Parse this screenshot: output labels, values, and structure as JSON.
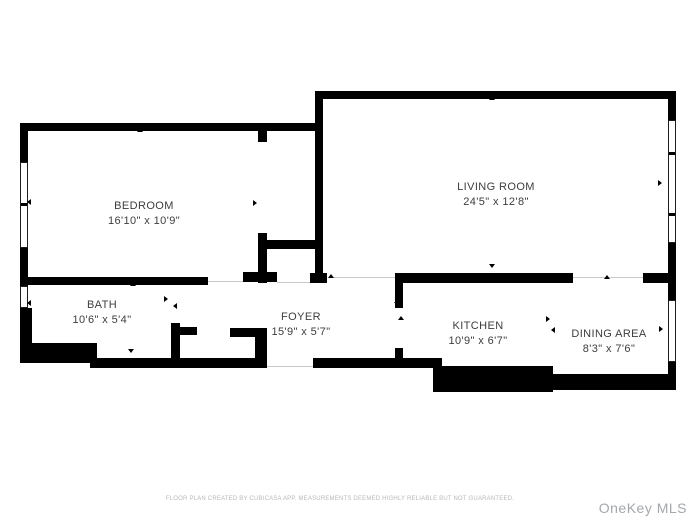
{
  "canvas": {
    "width": 693,
    "height": 520,
    "background": "#ffffff",
    "wall_color": "#000000",
    "label_color": "#3d3d3d"
  },
  "rooms": [
    {
      "id": "bedroom",
      "name": "BEDROOM",
      "dims": "16'10\" x 10'9\"",
      "cx": 144,
      "cy": 207
    },
    {
      "id": "living-room",
      "name": "LIVING ROOM",
      "dims": "24'5\" x 12'8\"",
      "cx": 496,
      "cy": 188
    },
    {
      "id": "bath",
      "name": "BATH",
      "dims": "10'6\" x 5'4\"",
      "cx": 102,
      "cy": 306
    },
    {
      "id": "foyer",
      "name": "FOYER",
      "dims": "15'9\" x 5'7\"",
      "cx": 301,
      "cy": 318
    },
    {
      "id": "kitchen",
      "name": "KITCHEN",
      "dims": "10'9\" x 6'7\"",
      "cx": 478,
      "cy": 327
    },
    {
      "id": "dining-area",
      "name": "DINING AREA",
      "dims": "8'3\" x 7'6\"",
      "cx": 609,
      "cy": 335
    }
  ],
  "walls": [
    {
      "x": 20,
      "y": 123,
      "w": 303,
      "h": 8
    },
    {
      "x": 20,
      "y": 123,
      "w": 8,
      "h": 39
    },
    {
      "x": 20,
      "y": 248,
      "w": 8,
      "h": 38
    },
    {
      "x": 20,
      "y": 277,
      "w": 188,
      "h": 8
    },
    {
      "x": 258,
      "y": 131,
      "w": 9,
      "h": 11
    },
    {
      "x": 258,
      "y": 233,
      "w": 9,
      "h": 50
    },
    {
      "x": 258,
      "y": 240,
      "w": 65,
      "h": 9
    },
    {
      "x": 243,
      "y": 272,
      "w": 34,
      "h": 10
    },
    {
      "x": 310,
      "y": 273,
      "w": 17,
      "h": 10
    },
    {
      "x": 315,
      "y": 91,
      "w": 361,
      "h": 8
    },
    {
      "x": 315,
      "y": 91,
      "w": 8,
      "h": 189
    },
    {
      "x": 668,
      "y": 91,
      "w": 8,
      "h": 29
    },
    {
      "x": 668,
      "y": 243,
      "w": 8,
      "h": 57
    },
    {
      "x": 643,
      "y": 273,
      "w": 33,
      "h": 10
    },
    {
      "x": 395,
      "y": 273,
      "w": 178,
      "h": 10
    },
    {
      "x": 20,
      "y": 308,
      "w": 12,
      "h": 37
    },
    {
      "x": 20,
      "y": 343,
      "w": 77,
      "h": 20
    },
    {
      "x": 90,
      "y": 358,
      "w": 177,
      "h": 10
    },
    {
      "x": 171,
      "y": 323,
      "w": 9,
      "h": 40
    },
    {
      "x": 171,
      "y": 327,
      "w": 26,
      "h": 8
    },
    {
      "x": 230,
      "y": 328,
      "w": 37,
      "h": 9
    },
    {
      "x": 255,
      "y": 328,
      "w": 12,
      "h": 35
    },
    {
      "x": 313,
      "y": 358,
      "w": 129,
      "h": 10
    },
    {
      "x": 395,
      "y": 275,
      "w": 8,
      "h": 33
    },
    {
      "x": 395,
      "y": 348,
      "w": 8,
      "h": 16
    },
    {
      "x": 433,
      "y": 366,
      "w": 120,
      "h": 26
    },
    {
      "x": 553,
      "y": 374,
      "w": 123,
      "h": 16
    },
    {
      "x": 668,
      "y": 362,
      "w": 8,
      "h": 28
    }
  ],
  "windows": [
    {
      "x": 20,
      "y": 162,
      "w": 8,
      "h": 86,
      "dividers": [
        40
      ]
    },
    {
      "x": 20,
      "y": 286,
      "w": 8,
      "h": 22,
      "dividers": []
    },
    {
      "x": 668,
      "y": 120,
      "w": 8,
      "h": 123,
      "dividers": [
        31,
        92
      ]
    },
    {
      "x": 668,
      "y": 300,
      "w": 8,
      "h": 62,
      "dividers": []
    }
  ],
  "opening_lines": [
    {
      "x": 330,
      "y": 277,
      "w": 65,
      "h": 1
    },
    {
      "x": 573,
      "y": 277,
      "w": 70,
      "h": 1
    },
    {
      "x": 277,
      "y": 282,
      "w": 33,
      "h": 1
    },
    {
      "x": 267,
      "y": 366,
      "w": 46,
      "h": 1
    },
    {
      "x": 208,
      "y": 281,
      "w": 35,
      "h": 1
    }
  ],
  "ticks": [
    {
      "x": 140,
      "y": 131,
      "d": "up"
    },
    {
      "x": 492,
      "y": 99,
      "d": "up"
    },
    {
      "x": 661,
      "y": 183,
      "d": "right"
    },
    {
      "x": 256,
      "y": 203,
      "d": "right"
    },
    {
      "x": 322,
      "y": 185,
      "d": "left"
    },
    {
      "x": 133,
      "y": 285,
      "d": "up"
    },
    {
      "x": 131,
      "y": 352,
      "d": "down"
    },
    {
      "x": 167,
      "y": 299,
      "d": "right"
    },
    {
      "x": 176,
      "y": 306,
      "d": "left"
    },
    {
      "x": 331,
      "y": 277,
      "d": "up"
    },
    {
      "x": 492,
      "y": 267,
      "d": "down"
    },
    {
      "x": 607,
      "y": 278,
      "d": "up"
    },
    {
      "x": 495,
      "y": 369,
      "d": "down"
    },
    {
      "x": 549,
      "y": 319,
      "d": "right"
    },
    {
      "x": 554,
      "y": 330,
      "d": "left"
    },
    {
      "x": 607,
      "y": 378,
      "d": "down"
    },
    {
      "x": 662,
      "y": 329,
      "d": "right"
    },
    {
      "x": 30,
      "y": 202,
      "d": "left"
    },
    {
      "x": 30,
      "y": 303,
      "d": "left"
    },
    {
      "x": 397,
      "y": 305,
      "d": "down"
    },
    {
      "x": 401,
      "y": 319,
      "d": "up"
    }
  ],
  "footer": {
    "text": "FLOOR PLAN CREATED BY CUBICASA APP. MEASUREMENTS DEEMED HIGHLY RELIABLE BUT NOT GUARANTEED."
  },
  "watermark": {
    "text": "OneKey MLS"
  }
}
